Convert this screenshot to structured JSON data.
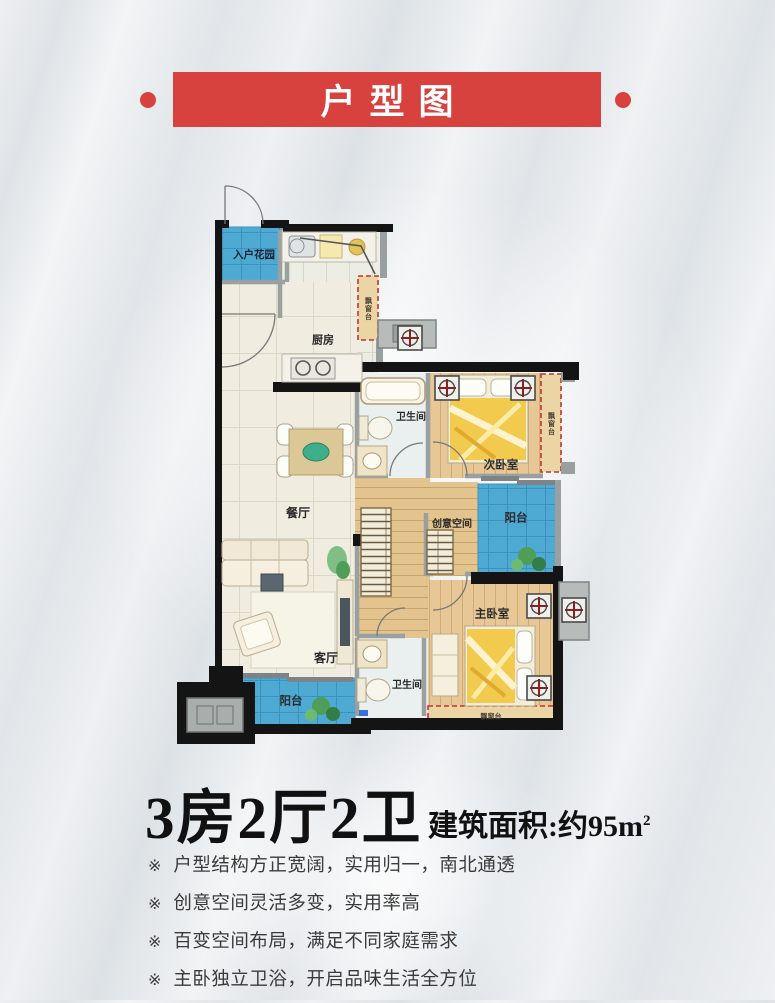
{
  "header": {
    "title": "户型图"
  },
  "floorplan": {
    "rooms": {
      "entry_garden": "入户花园",
      "kitchen": "厨房",
      "bathroom1": "卫生间",
      "second_bedroom": "次卧室",
      "dining": "餐厅",
      "creative_space": "创意空间",
      "balcony_right": "阳台",
      "master_bedroom": "主卧室",
      "bathroom2": "卫生间",
      "living": "客厅",
      "balcony_bottom": "阳台",
      "bay_window": "飘窗台"
    }
  },
  "summary": {
    "layout": "3房2厅2卫",
    "area_label": "建筑面积:约95m",
    "area_exponent": "2"
  },
  "features": {
    "marker": "※",
    "items": [
      "户型结构方正宽阔，实用归一，南北通透",
      "创意空间灵活多变，实用率高",
      "百变空间布局，满足不同家庭需求",
      "主卧独立卫浴，开启品味生活全方位"
    ]
  },
  "colors": {
    "accent_red": "#d8423e",
    "balcony_blue": "#4ea9d3",
    "wood_floor": "#e6c795",
    "wall_black": "#141414",
    "bay_window_red": "#c23434"
  }
}
